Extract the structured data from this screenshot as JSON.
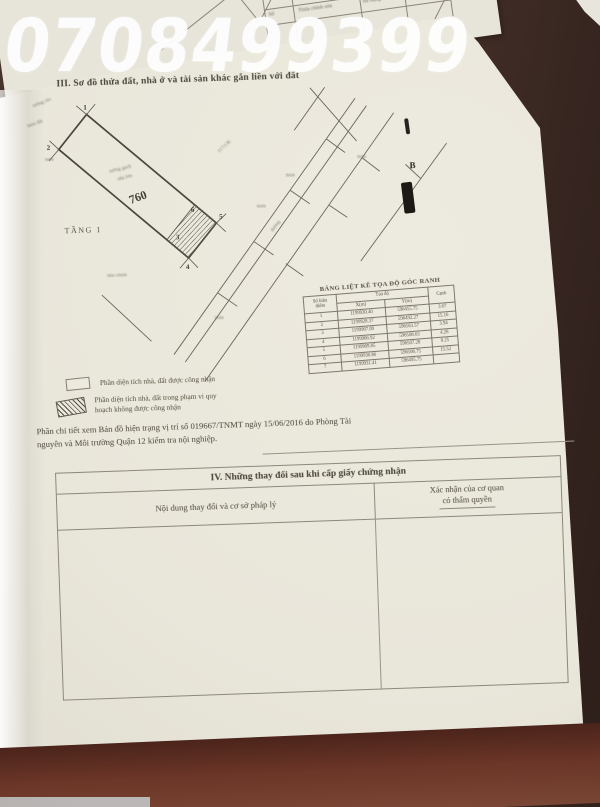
{
  "watermark": "0708499399",
  "back_sheet": {
    "table_title": "BẢNG CHỈ DẪN",
    "cells": {
      "c1": "Thửa",
      "c2": "DIỆN TÍCH",
      "c3": "Sử dụng",
      "c4": "Cấp lại",
      "c5": "Số",
      "c6": "Thửa chỉnh sửa"
    }
  },
  "section_iii": {
    "heading": "III. Sơ đồ thửa đất, nhà ở và tài sản khác gắn liền với đất"
  },
  "map": {
    "parcel_number": "760",
    "floor_label": "TẦNG 1",
    "direction_label": "B",
    "road_label": "đường",
    "points": [
      "1",
      "2",
      "3",
      "4",
      "5",
      "6"
    ],
    "small_labels": [
      {
        "text": "tường rào"
      },
      {
        "text": "hẻm đất"
      },
      {
        "text": "117/136"
      },
      {
        "text": "tường gạch"
      },
      {
        "text": "nhà lớn"
      },
      {
        "text": "thửa"
      },
      {
        "text": "thửa"
      },
      {
        "text": "thửa"
      },
      {
        "text": "nhà chính"
      },
      {
        "text": "hẻm"
      },
      {
        "text": "thửa"
      }
    ]
  },
  "coord_table": {
    "title": "BẢNG LIỆT KÊ TỌA ĐỘ GÓC RANH",
    "headers": {
      "no1": "Số hiệu",
      "no2": "điểm",
      "toado": "Tọa độ",
      "x": "X(m)",
      "y": "Y(m)",
      "canh": "Cạnh"
    },
    "rows": [
      {
        "n": "1",
        "x": "1199930.40",
        "y": "596455.75",
        "c": "3.67"
      },
      {
        "n": "2",
        "x": "1199928.37",
        "y": "596492.27",
        "c": "15.16"
      },
      {
        "n": "3",
        "x": "1199907.09",
        "y": "596503.57",
        "c": "3.94"
      },
      {
        "n": "4",
        "x": "1199906.92",
        "y": "596508.63",
        "c": "4.28"
      },
      {
        "n": "5",
        "x": "1199909.85",
        "y": "596507.28",
        "c": "0.25"
      },
      {
        "n": "6",
        "x": "1199930.86",
        "y": "596506.75",
        "c": "15.52"
      },
      {
        "n": "7",
        "x": "1199931.41",
        "y": "596495.75",
        "c": ""
      }
    ]
  },
  "legend": {
    "item1": "Phần diện tích nhà, đất được công nhận",
    "item2_line1": "Phần diện tích nhà, đất trong phạm vi quy",
    "item2_line2": "hoạch không được công nhận"
  },
  "note": {
    "line1": "Phần chi tiết xem Bản đồ hiện trạng vị trí số 019667/TNMT ngày 15/06/2016 do Phòng Tài",
    "line2": "nguyên và Môi trường Quận 12 kiểm tra nội nghiệp."
  },
  "section_iv": {
    "heading": "IV. Những thay đổi sau khi cấp giấy chứng nhận",
    "col1": "Nội dung thay đổi và cơ sở pháp lý",
    "col2_line1": "Xác nhận của cơ quan",
    "col2_line2": "có thẩm quyền"
  }
}
